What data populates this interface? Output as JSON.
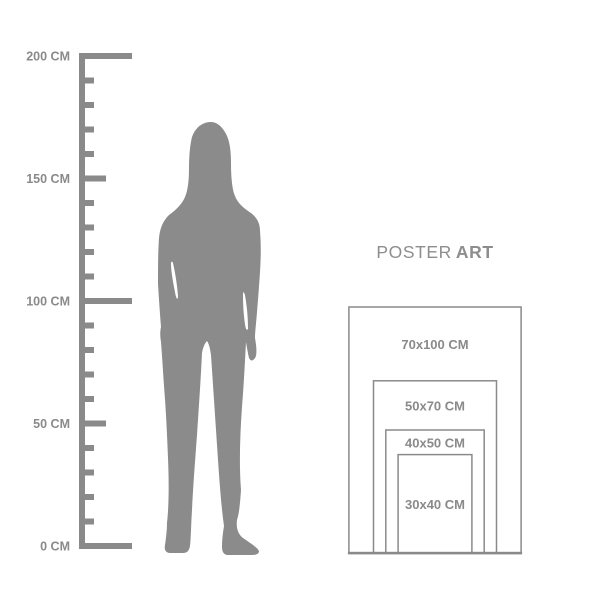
{
  "title": {
    "regular": "POSTER",
    "bold": "ART"
  },
  "ruler": {
    "unit": "CM",
    "max_cm": 200,
    "minor_step_cm": 10,
    "mid_step_cm": 50,
    "unit_labels": [
      {
        "cm": 200,
        "label": "200 CM"
      },
      {
        "cm": 150,
        "label": "150 CM"
      },
      {
        "cm": 100,
        "label": "100 CM"
      },
      {
        "cm": 50,
        "label": "50 CM"
      },
      {
        "cm": 0,
        "label": "0 CM"
      }
    ]
  },
  "figure": {
    "icon": "standing-woman-silhouette"
  },
  "size_chart": {
    "sizes": [
      {
        "label": "70x100 CM",
        "width_cm": 70,
        "height_cm": 100
      },
      {
        "label": "50x70 CM",
        "width_cm": 50,
        "height_cm": 70
      },
      {
        "label": "40x50 CM",
        "width_cm": 40,
        "height_cm": 50
      },
      {
        "label": "30x40 CM",
        "width_cm": 30,
        "height_cm": 40
      }
    ]
  },
  "colors": {
    "background": "#ffffff",
    "gray": "#8a8a8a",
    "silhouette": "#8b8b8b",
    "text_gray": "#8d8d8d"
  }
}
